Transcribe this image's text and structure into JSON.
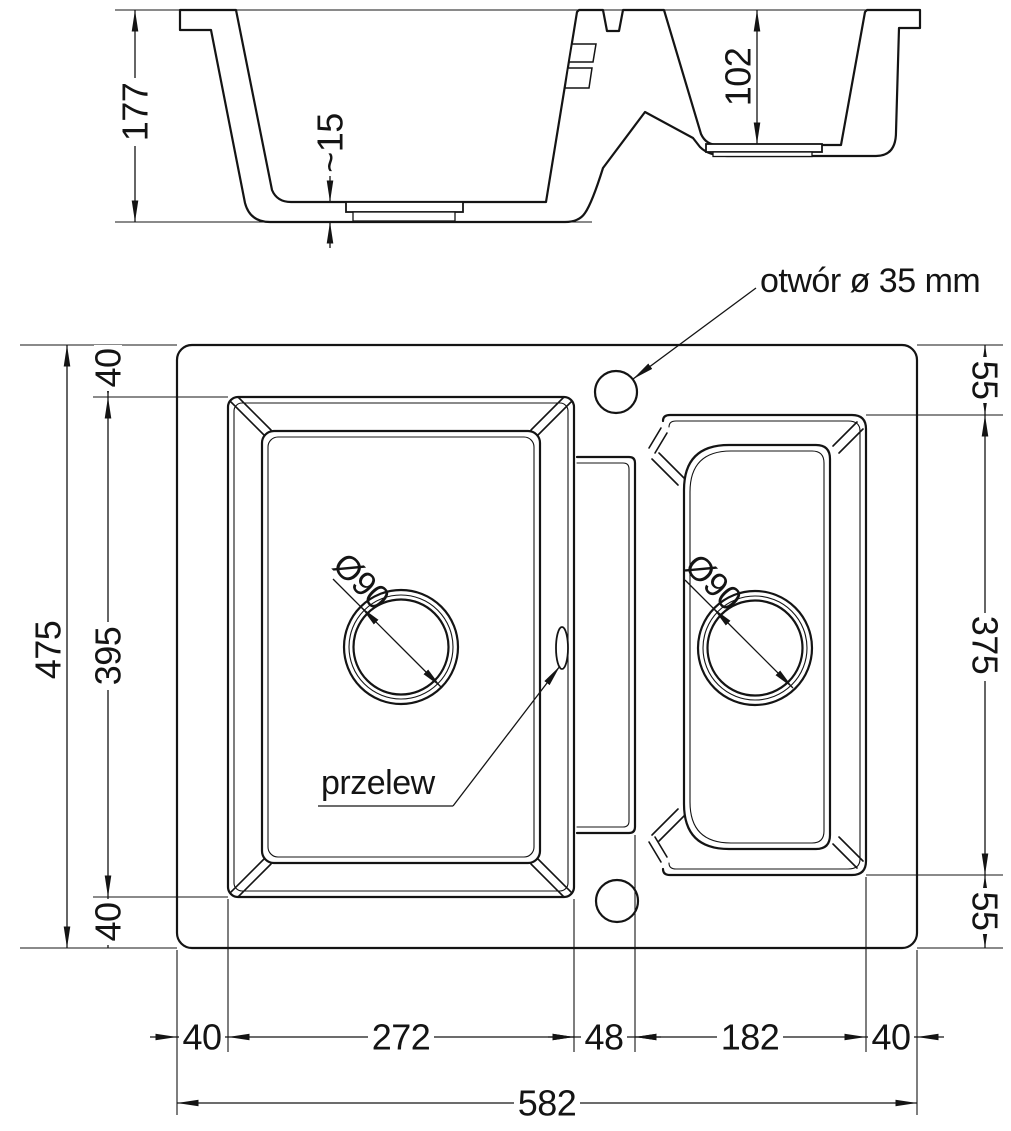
{
  "drawing": {
    "section": {
      "overall_depth": "177",
      "bottom_thickness": "~15",
      "small_bowl_depth": "102"
    },
    "plan": {
      "overall_height": "475",
      "left_offset_top": "40",
      "bowl_opening_height": "395",
      "left_offset_bottom": "40",
      "right_offset_top": "55",
      "small_bowl_height": "375",
      "right_offset_bottom": "55",
      "margin_left": "40",
      "main_bowl_width": "272",
      "divider_width": "48",
      "small_bowl_width": "182",
      "margin_right": "40",
      "overall_width": "582",
      "main_drain_diameter": "Ø90",
      "small_drain_diameter": "Ø90",
      "tap_hole_note": "otwór ø 35 mm",
      "overflow_note": "przelew"
    },
    "colors": {
      "line": "#141414",
      "background": "#ffffff"
    }
  }
}
